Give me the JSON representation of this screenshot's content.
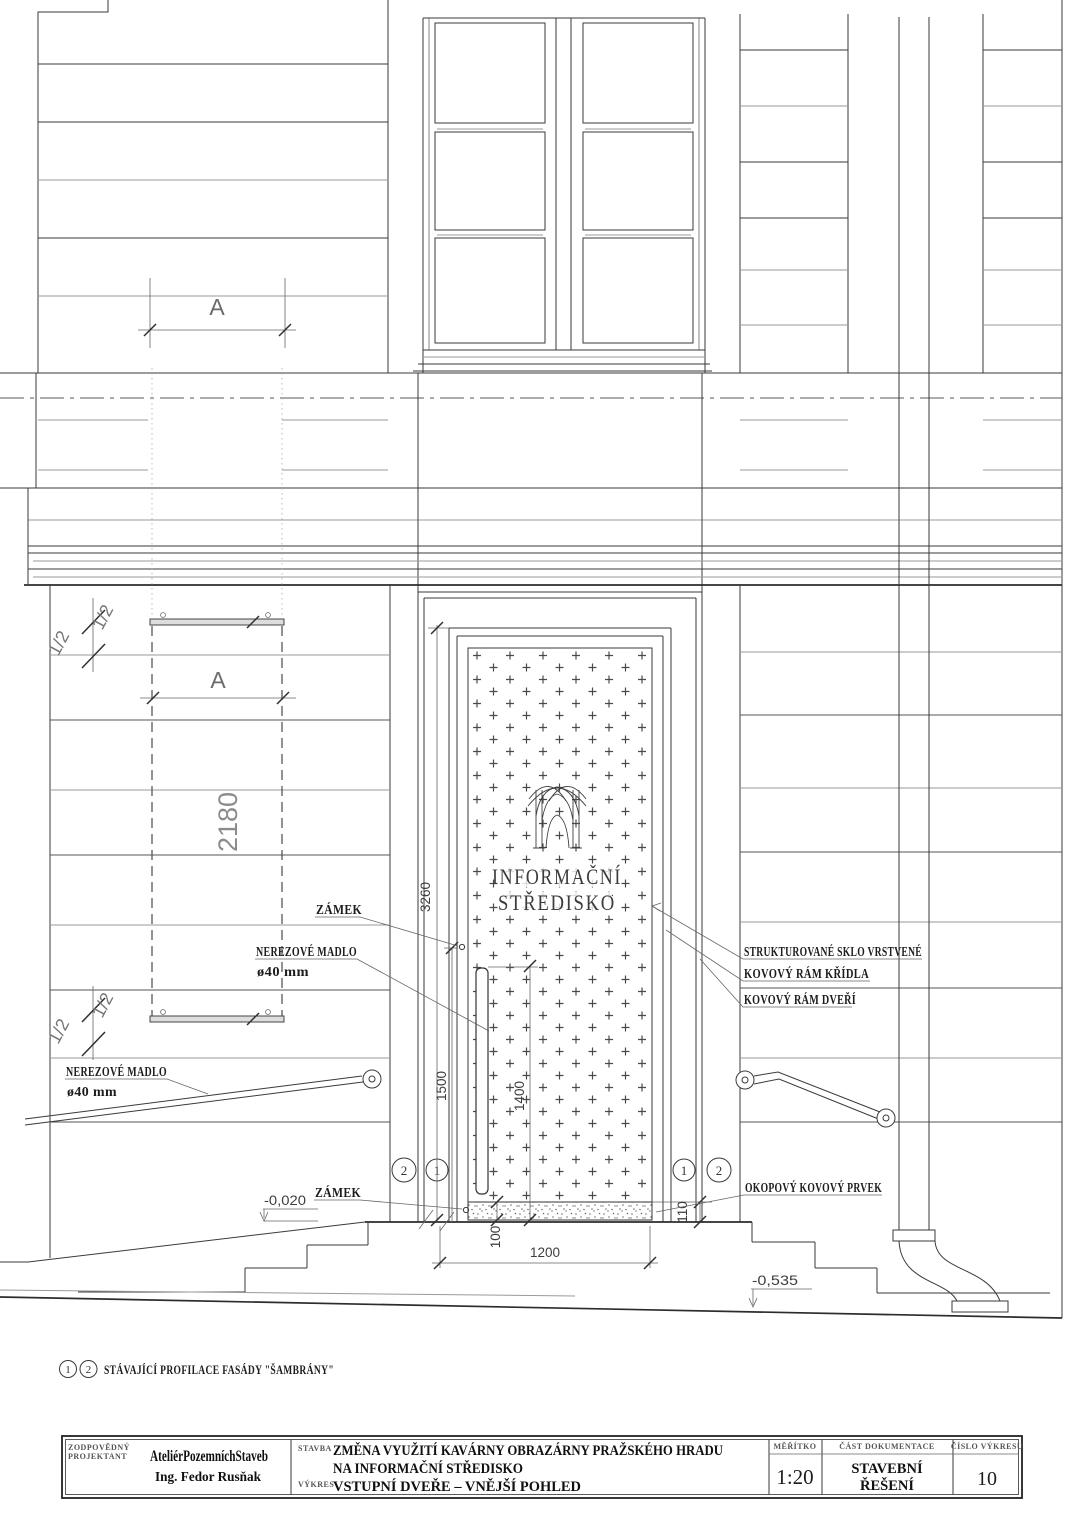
{
  "sign": {
    "line1": "INFORMAČNÍ",
    "line2": "STŘEDISKO"
  },
  "callouts": {
    "lock": "ZÁMEK",
    "handle_line1": "NEREZOVÉ MADLO",
    "handle_line2": "ø40 mm",
    "glass": "STRUKTUROVANÉ SKLO VRSTVENÉ",
    "leaf_frame": "KOVOVÝ RÁM KŘÍDLA",
    "door_frame": "KOVOVÝ RÁM DVEŘÍ",
    "kick_plate": "OKOPOVÝ KOVOVÝ PRVEK"
  },
  "dims": {
    "door_height": "3260",
    "lock_height": "1500",
    "handle_height": "1400",
    "door_width": "1200",
    "kick_height": "100",
    "frame_bottom": "110",
    "detail_height": "2180",
    "section_letter": "A",
    "half": "1/2"
  },
  "levels": {
    "entry": "-0,020",
    "terrain": "-0,535"
  },
  "markers": {
    "m1": "1",
    "m2": "2"
  },
  "note": {
    "text": "STÁVAJÍCÍ PROFILACE FASÁDY \"ŠAMBRÁNY\""
  },
  "titleblock": {
    "responsible_label1": "ZODPOVĚDNÝ",
    "responsible_label2": "PROJEKTANT",
    "studio": "AteliérPozemníchStaveb",
    "engineer": "Ing. Fedor Rusňak",
    "project_label": "STAVBA",
    "project_line1": "ZMĚNA VYUŽITÍ KAVÁRNY OBRAZÁRNY PRAŽSKÉHO HRADU",
    "project_line2": "NA INFORMAČNÍ STŘEDISKO",
    "drawing_label": "VÝKRES",
    "drawing_title": "VSTUPNÍ DVEŘE – VNĚJŠÍ POHLED",
    "scale_label": "MĚŘÍTKO",
    "scale_value": "1:20",
    "part_label": "ČÁST DOKUMENTACE",
    "part_line1": "STAVEBNÍ",
    "part_line2": "ŘEŠENÍ",
    "number_label": "ČÍSLO VÝKRESU",
    "number_value": "10"
  }
}
